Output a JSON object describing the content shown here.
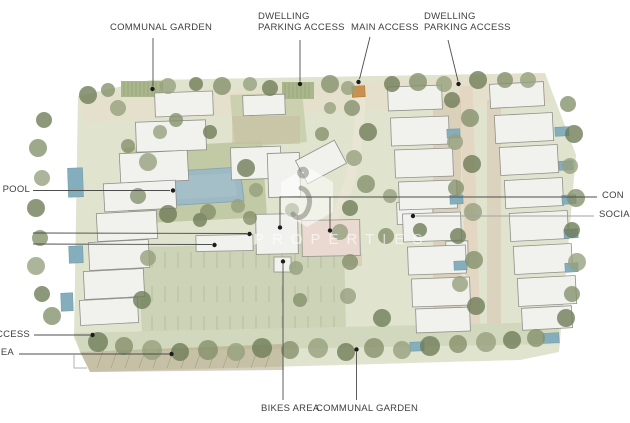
{
  "canvas": {
    "width": 630,
    "height": 423,
    "background": "#ffffff"
  },
  "plan_colors": {
    "ground": "#e0e3cd",
    "paving": "#e6dfcb",
    "lawn": "#bcc49e",
    "parking_lot": "#ccd3b7",
    "communal_pool_water": "#9db9c4",
    "private_pool_water": "#85aebc",
    "building_fill": "#f1f1ed",
    "building_stroke": "#90908a",
    "pink_building": "#ead9d0",
    "road": "#d2d8bd",
    "terracotta_paving": "#cfa893",
    "gate_orange": "#c99150",
    "tree_greens": [
      "#84906b",
      "#6e7c57",
      "#95a07d"
    ],
    "label_text": "#3f3f3f",
    "leader_line": "#4d4d4d",
    "leader_dot": "#1c1c1c"
  },
  "watermark": {
    "logo_icon": "hexagon-i-logo",
    "text": "PROPERTIES"
  },
  "labels": {
    "communal_garden_top": {
      "text": "COMMUNAL GARDEN"
    },
    "dwelling_parking_left": {
      "line1": "DWELLING",
      "line2": "PARKING ACCESS"
    },
    "main_access": {
      "text": "MAIN ACCESS"
    },
    "dwelling_parking_right": {
      "line1": "DWELLING",
      "line2": "PARKING ACCESS"
    },
    "swimming_pool": {
      "text": "NG POOL"
    },
    "access_left": {
      "text": "ACCESS"
    },
    "area_left": {
      "text": "EA"
    },
    "communal_right": {
      "text": "CON"
    },
    "social_right": {
      "text": "SOCIA"
    },
    "bikes_area": {
      "text": "BIKES AREA"
    },
    "communal_garden_bottom": {
      "text": "COMMUNAL GARDEN"
    }
  }
}
